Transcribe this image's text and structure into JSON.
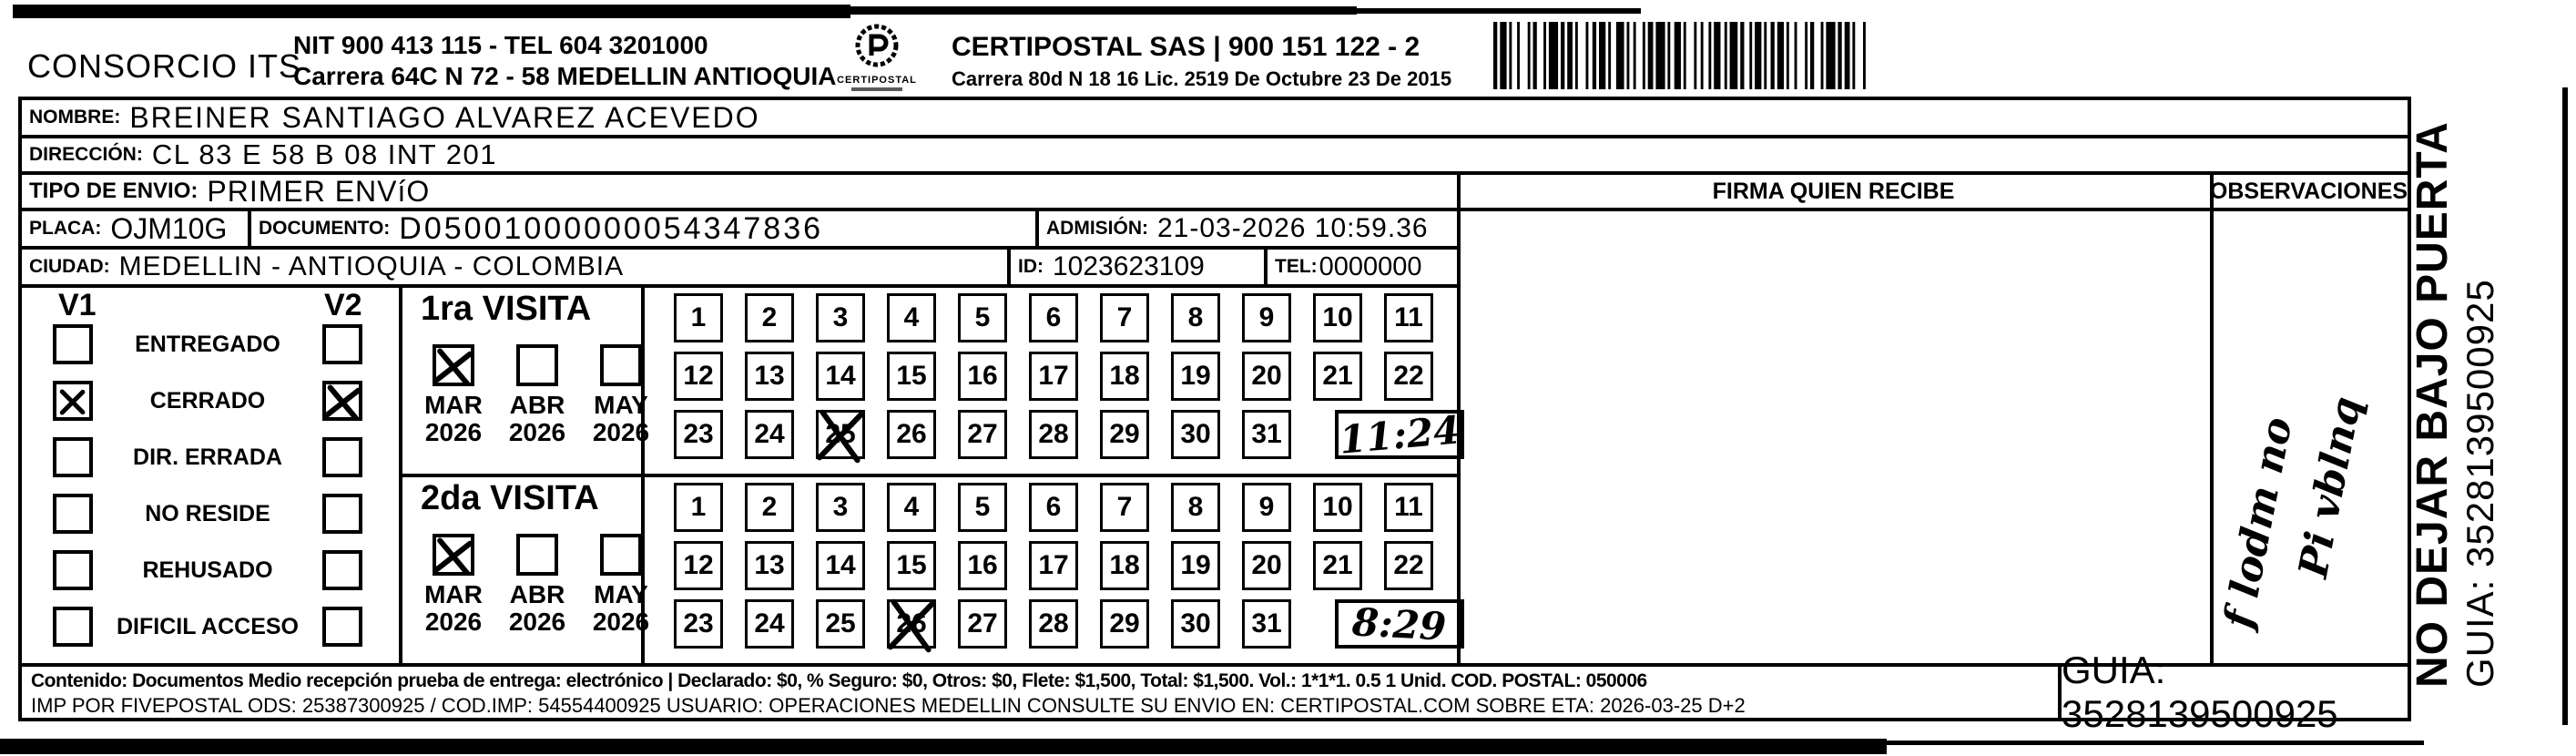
{
  "header": {
    "company": "CONSORCIO ITS",
    "nit_tel": "NIT 900 413 115 - TEL 604 3201000",
    "company_address": "Carrera 64C N 72 - 58 MEDELLIN ANTIOQUIA",
    "logo_caption": "CERTIPOSTAL",
    "carrier": "CERTIPOSTAL SAS | 900 151 122 - 2",
    "carrier_address": "Carrera 80d N 18 16  Lic. 2519 De Octubre 23 De 2015"
  },
  "shipment": {
    "nombre_label": "NOMBRE:",
    "nombre": "BREINER SANTIAGO ALVAREZ ACEVEDO",
    "direccion_label": "DIRECCIÓN:",
    "direccion": "CL 83 E 58 B 08 INT 201",
    "tipo_envio_label": "TIPO DE ENVIO:",
    "tipo_envio": "PRIMER ENVíO",
    "placa_label": "PLACA:",
    "placa": "OJM10G",
    "documento_label": "DOCUMENTO:",
    "documento": "D05001000000054347836",
    "admision_label": "ADMISIÓN:",
    "admision": "21-03-2026 10:59.36",
    "ciudad_label": "CIUDAD:",
    "ciudad": "MEDELLIN - ANTIOQUIA - COLOMBIA",
    "id_label": "ID:",
    "id": "1023623109",
    "tel_label": "TEL:",
    "tel": "0000000"
  },
  "table_headers": {
    "firma": "FIRMA QUIEN RECIBE",
    "observaciones": "OBSERVACIONES"
  },
  "status_panel": {
    "col1": "V1",
    "col2": "V2",
    "options": [
      {
        "label": "ENTREGADO",
        "v1_checked": false,
        "v2_checked": false
      },
      {
        "label": "CERRADO",
        "v1_checked": true,
        "v2_checked": true
      },
      {
        "label": "DIR. ERRADA",
        "v1_checked": false,
        "v2_checked": false
      },
      {
        "label": "NO RESIDE",
        "v1_checked": false,
        "v2_checked": false
      },
      {
        "label": "REHUSADO",
        "v1_checked": false,
        "v2_checked": false
      },
      {
        "label": "DIFICIL ACCESO",
        "v1_checked": false,
        "v2_checked": false
      }
    ]
  },
  "calendar_rows": [
    [
      1,
      2,
      3,
      4,
      5,
      6,
      7,
      8,
      9,
      10,
      11
    ],
    [
      12,
      13,
      14,
      15,
      16,
      17,
      18,
      19,
      20,
      21,
      22
    ],
    [
      23,
      24,
      25,
      26,
      27,
      28,
      29,
      30,
      31
    ]
  ],
  "visits": [
    {
      "title": "1ra VISITA",
      "months": [
        {
          "month": "MAR",
          "year": "2026",
          "checked": true
        },
        {
          "month": "ABR",
          "year": "2026",
          "checked": false
        },
        {
          "month": "MAY",
          "year": "2026",
          "checked": false
        }
      ],
      "crossed_day": 25,
      "time_written": "11:24"
    },
    {
      "title": "2da VISITA",
      "months": [
        {
          "month": "MAR",
          "year": "2026",
          "checked": true
        },
        {
          "month": "ABR",
          "year": "2026",
          "checked": false
        },
        {
          "month": "MAY",
          "year": "2026",
          "checked": false
        }
      ],
      "crossed_day": 26,
      "time_written": "8:29"
    }
  ],
  "observaciones_note": {
    "line1": "f lodm no",
    "line2": "Pi vblnq"
  },
  "side_strip": {
    "instruction": "NO DEJAR BAJO PUERTA",
    "guia": "GUIA: 3528139500925"
  },
  "footer": {
    "line1": "Contenido: Documentos Medio recepción prueba de entrega: electrónico | Declarado: $0, % Seguro: $0, Otros: $0, Flete: $1,500, Total: $1,500. Vol.: 1*1*1. 0.5 1 Unid. COD. POSTAL: 050006",
    "line2": "IMP POR FIVEPOSTAL ODS: 25387300925 / COD.IMP: 54554400925 USUARIO: OPERACIONES MEDELLIN CONSULTE SU ENVIO EN: CERTIPOSTAL.COM SOBRE ETA: 2026-03-25 D+2",
    "guia_box": "GUIA: 3528139500925"
  },
  "colors": {
    "ink": "#000000",
    "paper": "#ffffff"
  }
}
